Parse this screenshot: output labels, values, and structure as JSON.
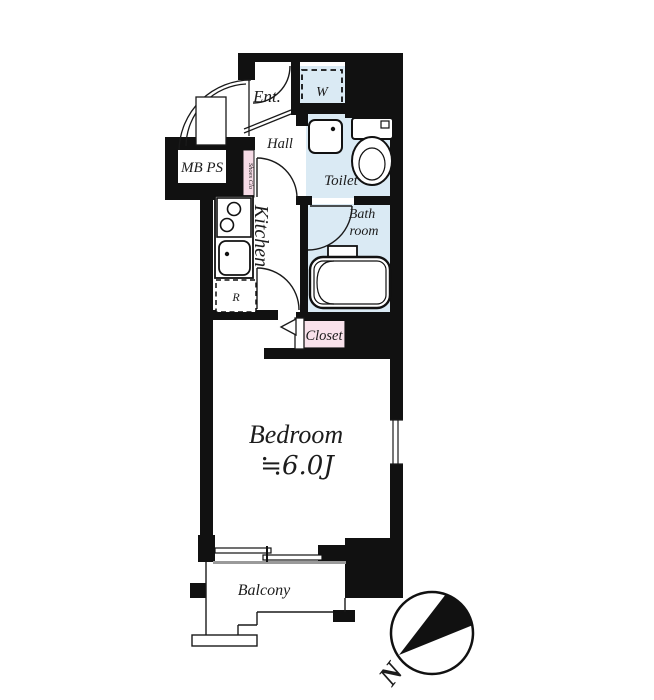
{
  "plan": {
    "type": "apartment-floor-plan",
    "rooms": {
      "entrance": {
        "label": "Ent."
      },
      "washer": {
        "label": "W"
      },
      "hall": {
        "label": "Hall"
      },
      "toilet": {
        "label": "Toilet"
      },
      "meter_box": {
        "label": "MB PS"
      },
      "shoes_closet": {
        "label": "Shoes Clo"
      },
      "kitchen": {
        "label": "Kitchen"
      },
      "refrigerator": {
        "label": "R"
      },
      "bathroom": {
        "label_line1": "Bath",
        "label_line2": "room"
      },
      "closet": {
        "label": "Closet"
      },
      "bedroom": {
        "label": "Bedroom",
        "size": "≒6.0J"
      },
      "balcony": {
        "label": "Balcony"
      }
    },
    "compass": {
      "label": "N"
    },
    "colors": {
      "wall": "#111111",
      "water_room_fill": "#daeaf4",
      "closet_fill": "#f9e2eb",
      "line": "#1a1a1a"
    }
  }
}
